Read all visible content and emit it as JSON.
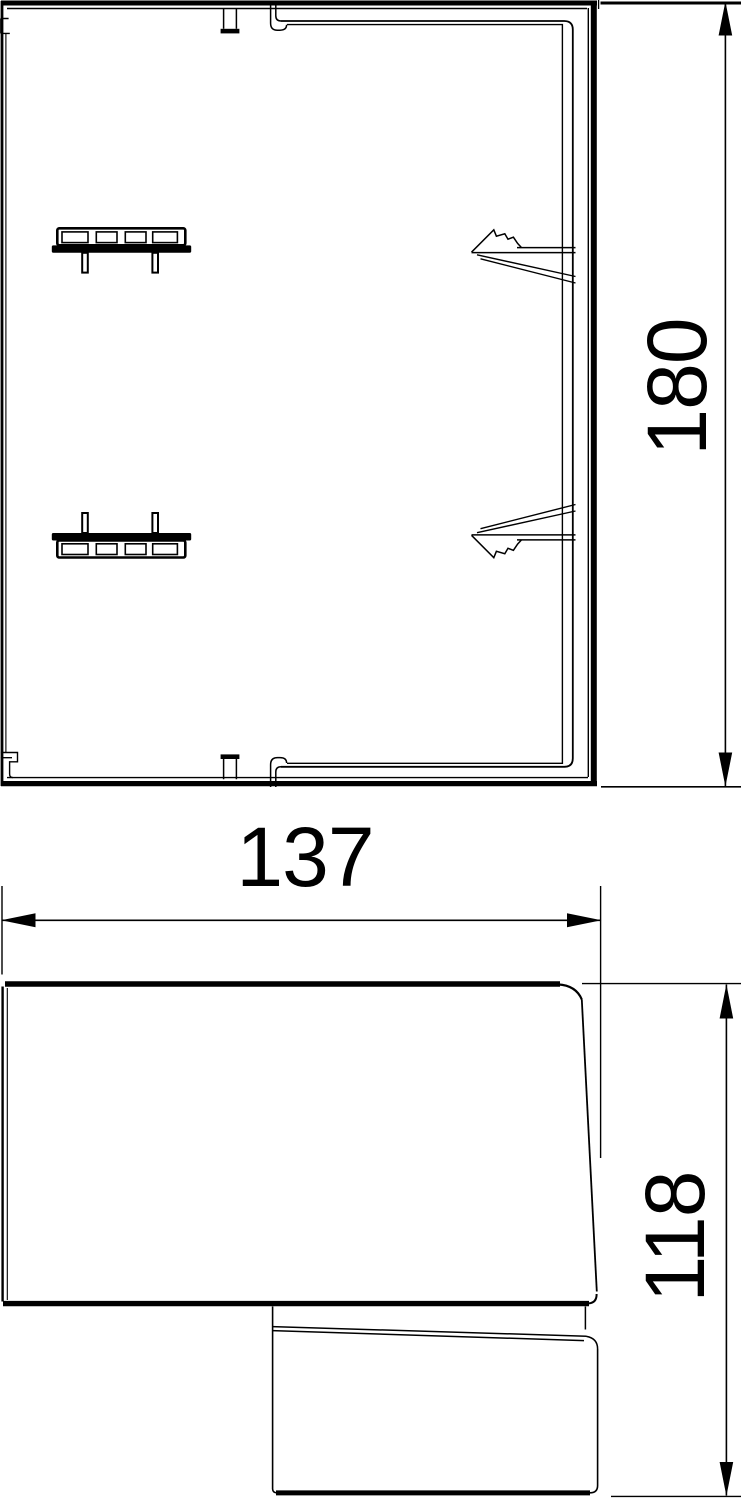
{
  "drawing": {
    "description": "Two-view technical dimension drawing of a trunking end cap",
    "colors": {
      "line": "#000000",
      "background": "#ffffff"
    },
    "dimensions": {
      "height": {
        "value": "180",
        "orientation": "vertical",
        "view": "top"
      },
      "width": {
        "value": "137",
        "orientation": "horizontal",
        "view": "side"
      },
      "depth": {
        "value": "118",
        "orientation": "vertical",
        "view": "side"
      }
    }
  }
}
